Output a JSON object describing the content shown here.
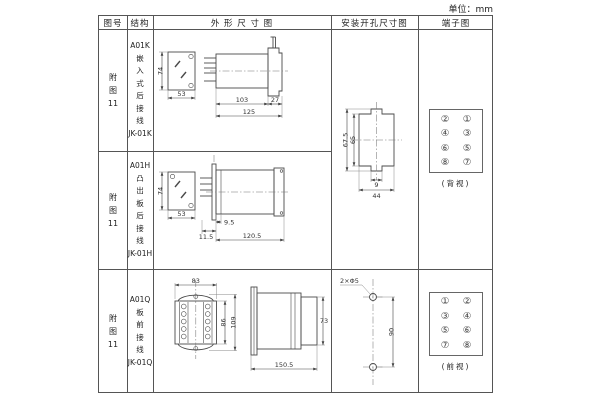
{
  "page": {
    "unit": "单位：mm"
  },
  "header": {
    "figure": "图号",
    "structure": "结构",
    "outline": "外 形 尺 寸 图",
    "mounting": "安装开孔尺寸图",
    "terminal": "端子图"
  },
  "rows": {
    "r1": {
      "figure": "附\n图\n11",
      "structure": "A01K\n嵌\n入\n式\n后\n接\n线\nJK-01K"
    },
    "r2": {
      "figure": "附\n图\n11",
      "structure": "A01H\n凸\n出\n板\n后\n接\n线\nJK-01H"
    },
    "r3": {
      "figure": "附\n图\n11",
      "structure": "A01Q\n板\n前\n接\n线\nJK-01Q"
    }
  },
  "dims": {
    "a01k": {
      "h": "74",
      "w": "53",
      "body": "103",
      "flange": "27",
      "total": "125"
    },
    "a01h": {
      "h": "74",
      "w": "53",
      "inset": "9.5",
      "offset": "11.5",
      "total": "120.5"
    },
    "a01q": {
      "top": "83",
      "inner": "86",
      "height": "109",
      "side_h": "73",
      "total": "150.5"
    },
    "mount_rear": {
      "outer_h": "67.5",
      "inner_h": "65",
      "slot": "9",
      "width": "44"
    },
    "mount_front": {
      "holes": "2×Φ5",
      "spacing": "90"
    }
  },
  "terminals": {
    "rear": {
      "cells": [
        "②",
        "①",
        "④",
        "③",
        "⑥",
        "⑤",
        "⑧",
        "⑦"
      ],
      "caption": "(背视)"
    },
    "front": {
      "cells": [
        "①",
        "②",
        "③",
        "④",
        "⑤",
        "⑥",
        "⑦",
        "⑧"
      ],
      "caption": "(前视)"
    }
  },
  "colors": {
    "line": "#4a4a4a",
    "border": "#555555",
    "text": "#222222"
  }
}
